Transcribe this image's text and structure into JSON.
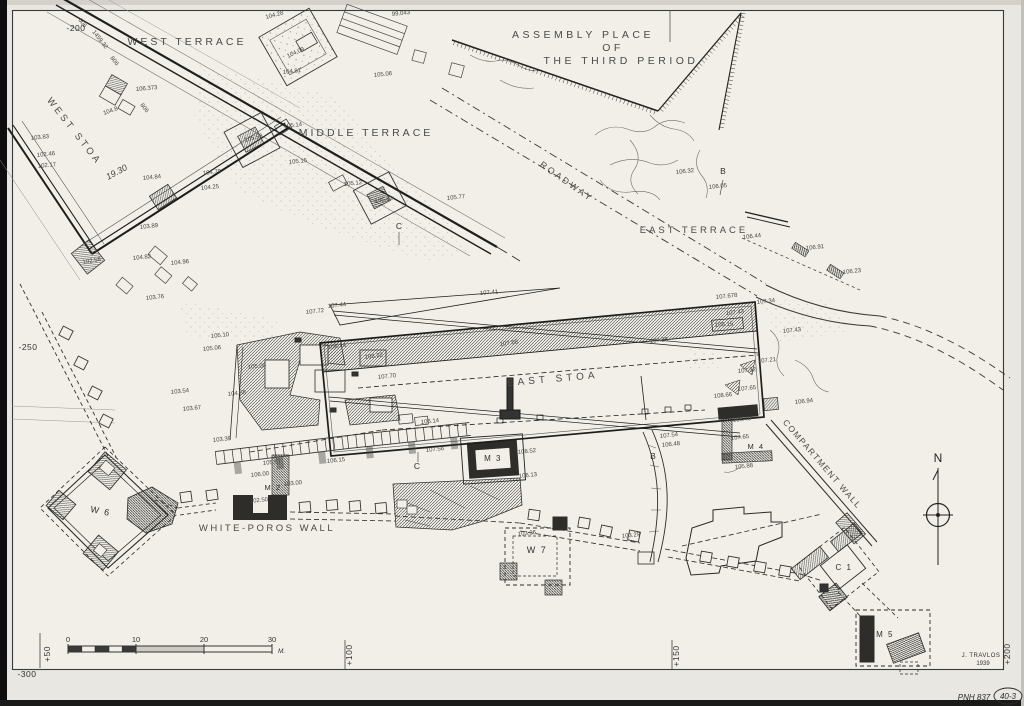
{
  "plan": {
    "region_labels": [
      {
        "text": "WEST TERRACE"
      },
      {
        "text": "MIDDLE TERRACE"
      },
      {
        "text": "ASSEMBLY PLACE"
      },
      {
        "text": "OF"
      },
      {
        "text": "THE THIRD PERIOD"
      },
      {
        "text": "WEST STOA"
      },
      {
        "text": "ROADWAY"
      },
      {
        "text": "EAST TERRACE"
      },
      {
        "text": "EAST STOA"
      },
      {
        "text": "COMPARTMENT WALL"
      },
      {
        "text": "WHITE-POROS WALL"
      }
    ],
    "structure_labels": [
      {
        "text": "W 6"
      },
      {
        "text": "W 7"
      },
      {
        "text": "M 2"
      },
      {
        "text": "M 3"
      },
      {
        "text": "M 4"
      },
      {
        "text": "M 5"
      },
      {
        "text": "C 1"
      }
    ],
    "section_markers": [
      {
        "text": "B"
      },
      {
        "text": "B"
      },
      {
        "text": "C"
      },
      {
        "text": "C"
      }
    ],
    "grid": {
      "left_ticks": [
        {
          "label": "-200"
        },
        {
          "label": "-250"
        },
        {
          "label": "-300"
        }
      ],
      "bottom_ticks": [
        {
          "label": "+50"
        },
        {
          "label": "+100"
        },
        {
          "label": "+150"
        },
        {
          "label": "+200"
        }
      ]
    },
    "scale_bar": {
      "tick_labels": [
        "0",
        "10",
        "20",
        "30"
      ],
      "unit": "M."
    },
    "compass": {
      "label": "N"
    },
    "credits": {
      "surveyor": "J. TRAVLOS",
      "year": "1939"
    },
    "margin_notes": {
      "catalog": "PNH 837",
      "sheet": "40-3"
    },
    "wall_dimension_marks": [
      {
        "t": "606",
        "x": 78,
        "y": 20,
        "r": 52
      },
      {
        "t": "1459.32",
        "x": 92,
        "y": 32,
        "r": 52
      },
      {
        "t": "806",
        "x": 110,
        "y": 58,
        "r": 52
      },
      {
        "t": "806",
        "x": 140,
        "y": 105,
        "r": 52
      },
      {
        "t": "19.30",
        "x": 108,
        "y": 180,
        "r": -28,
        "s": 9,
        "it": true
      }
    ],
    "elevation_marks": [
      {
        "t": "99.043",
        "x": 392,
        "y": 16
      },
      {
        "t": "105.06",
        "x": 374,
        "y": 77
      },
      {
        "t": "104.28",
        "x": 266,
        "y": 19,
        "r": -15
      },
      {
        "t": "104.09",
        "x": 288,
        "y": 58,
        "r": -25
      },
      {
        "t": "104.81",
        "x": 283,
        "y": 74
      },
      {
        "t": "105.14",
        "x": 284,
        "y": 128
      },
      {
        "t": "105.58",
        "x": 245,
        "y": 142,
        "r": -15
      },
      {
        "t": "105.15",
        "x": 289,
        "y": 164
      },
      {
        "t": "105.12",
        "x": 344,
        "y": 186
      },
      {
        "t": "105.42",
        "x": 375,
        "y": 203,
        "r": -10
      },
      {
        "t": "105.77",
        "x": 447,
        "y": 200
      },
      {
        "t": "106.373",
        "x": 136,
        "y": 91,
        "r": -5
      },
      {
        "t": "104.8",
        "x": 104,
        "y": 115,
        "r": -20
      },
      {
        "t": "103.83",
        "x": 31,
        "y": 140
      },
      {
        "t": "102.46",
        "x": 37,
        "y": 157
      },
      {
        "t": "102.17",
        "x": 38,
        "y": 168
      },
      {
        "t": "104.84",
        "x": 143,
        "y": 180
      },
      {
        "t": "104.79",
        "x": 203,
        "y": 175
      },
      {
        "t": "104.25",
        "x": 201,
        "y": 190
      },
      {
        "t": "103.89",
        "x": 140,
        "y": 229
      },
      {
        "t": "104.82",
        "x": 133,
        "y": 260
      },
      {
        "t": "104.96",
        "x": 171,
        "y": 265
      },
      {
        "t": "103.76",
        "x": 146,
        "y": 300
      },
      {
        "t": "102.58",
        "x": 83,
        "y": 264,
        "r": -10
      },
      {
        "t": "106.32",
        "x": 676,
        "y": 174
      },
      {
        "t": "106.05",
        "x": 709,
        "y": 189
      },
      {
        "t": "106.44",
        "x": 743,
        "y": 239
      },
      {
        "t": "106.91",
        "x": 806,
        "y": 250
      },
      {
        "t": "106.23",
        "x": 843,
        "y": 274
      },
      {
        "t": "107.678",
        "x": 716,
        "y": 299
      },
      {
        "t": "107.34",
        "x": 757,
        "y": 304
      },
      {
        "t": "107.43",
        "x": 783,
        "y": 333
      },
      {
        "t": "107.43",
        "x": 726,
        "y": 315
      },
      {
        "t": "108.15",
        "x": 715,
        "y": 327,
        "r": -5
      },
      {
        "t": "107.26",
        "x": 650,
        "y": 343
      },
      {
        "t": "107.58",
        "x": 500,
        "y": 346,
        "r": -8
      },
      {
        "t": "108.44",
        "x": 328,
        "y": 349
      },
      {
        "t": "108.22",
        "x": 365,
        "y": 359,
        "r": -8
      },
      {
        "t": "107.70",
        "x": 378,
        "y": 379
      },
      {
        "t": "107.41",
        "x": 480,
        "y": 295,
        "r": -5
      },
      {
        "t": "107.72",
        "x": 306,
        "y": 314
      },
      {
        "t": "107.44",
        "x": 328,
        "y": 308
      },
      {
        "t": "107.21",
        "x": 758,
        "y": 363
      },
      {
        "t": "107.32",
        "x": 738,
        "y": 373
      },
      {
        "t": "107.65",
        "x": 738,
        "y": 391
      },
      {
        "t": "108.66",
        "x": 714,
        "y": 398
      },
      {
        "t": "106.94",
        "x": 795,
        "y": 404
      },
      {
        "t": "108.40",
        "x": 733,
        "y": 422
      },
      {
        "t": "107.65",
        "x": 731,
        "y": 440
      },
      {
        "t": "105.88",
        "x": 735,
        "y": 469
      },
      {
        "t": "107.54",
        "x": 660,
        "y": 438
      },
      {
        "t": "106.48",
        "x": 662,
        "y": 447
      },
      {
        "t": "106.14",
        "x": 421,
        "y": 424
      },
      {
        "t": "107.56",
        "x": 426,
        "y": 452
      },
      {
        "t": "108.52",
        "x": 518,
        "y": 454
      },
      {
        "t": "106.13",
        "x": 519,
        "y": 478
      },
      {
        "t": "103.36",
        "x": 518,
        "y": 536
      },
      {
        "t": "103.29",
        "x": 622,
        "y": 538
      },
      {
        "t": "106.00",
        "x": 251,
        "y": 477
      },
      {
        "t": "103.00",
        "x": 284,
        "y": 486
      },
      {
        "t": "103.39",
        "x": 213,
        "y": 442
      },
      {
        "t": "102.50",
        "x": 250,
        "y": 503
      },
      {
        "t": "105.87",
        "x": 263,
        "y": 465
      },
      {
        "t": "106.15",
        "x": 327,
        "y": 463
      },
      {
        "t": "105.10",
        "x": 211,
        "y": 338
      },
      {
        "t": "105.06",
        "x": 203,
        "y": 351
      },
      {
        "t": "105.09",
        "x": 248,
        "y": 369
      },
      {
        "t": "103.54",
        "x": 171,
        "y": 394
      },
      {
        "t": "103.67",
        "x": 183,
        "y": 411
      },
      {
        "t": "104.68",
        "x": 228,
        "y": 396
      }
    ]
  }
}
